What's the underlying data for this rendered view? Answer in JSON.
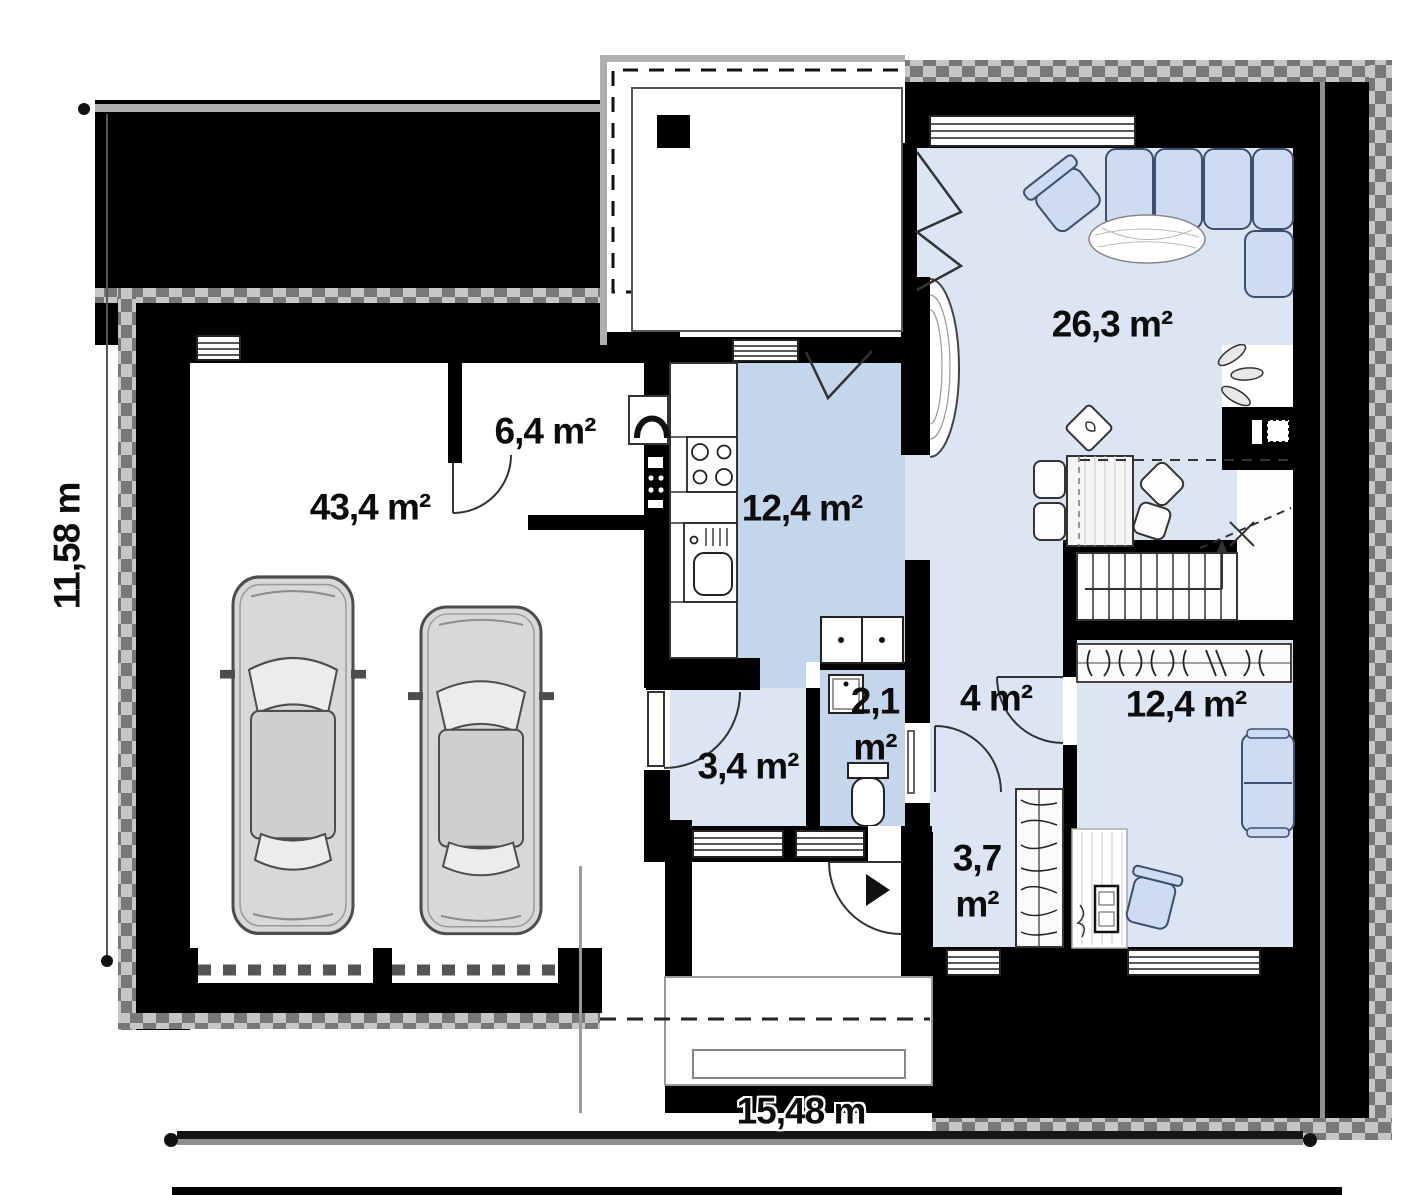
{
  "plan": {
    "type": "floor-plan",
    "dimensions": {
      "width_label": "15,48 m",
      "height_label": "11,58 m"
    },
    "rooms": [
      {
        "name": "garage",
        "area": "43,4 m²"
      },
      {
        "name": "storage",
        "area": "6,4 m²"
      },
      {
        "name": "kitchen",
        "area": "12,4 m²"
      },
      {
        "name": "living-room",
        "area": "26,3 m²"
      },
      {
        "name": "garage-hall",
        "area": "3,4 m²"
      },
      {
        "name": "wc",
        "value": "2,1",
        "unit": "m²"
      },
      {
        "name": "hall",
        "area": "4 m²"
      },
      {
        "name": "pantry",
        "value": "3,7",
        "unit": "m²"
      },
      {
        "name": "bedroom",
        "area": "12,4 m²"
      }
    ],
    "colors": {
      "wall": "#000000",
      "room_light": "#dbe5f3",
      "room_dark": "#c3d6ec",
      "furniture_fill": "#cddcf2",
      "roof_edge_dark": "#787878",
      "roof_edge_light": "#c6c6c6"
    }
  }
}
